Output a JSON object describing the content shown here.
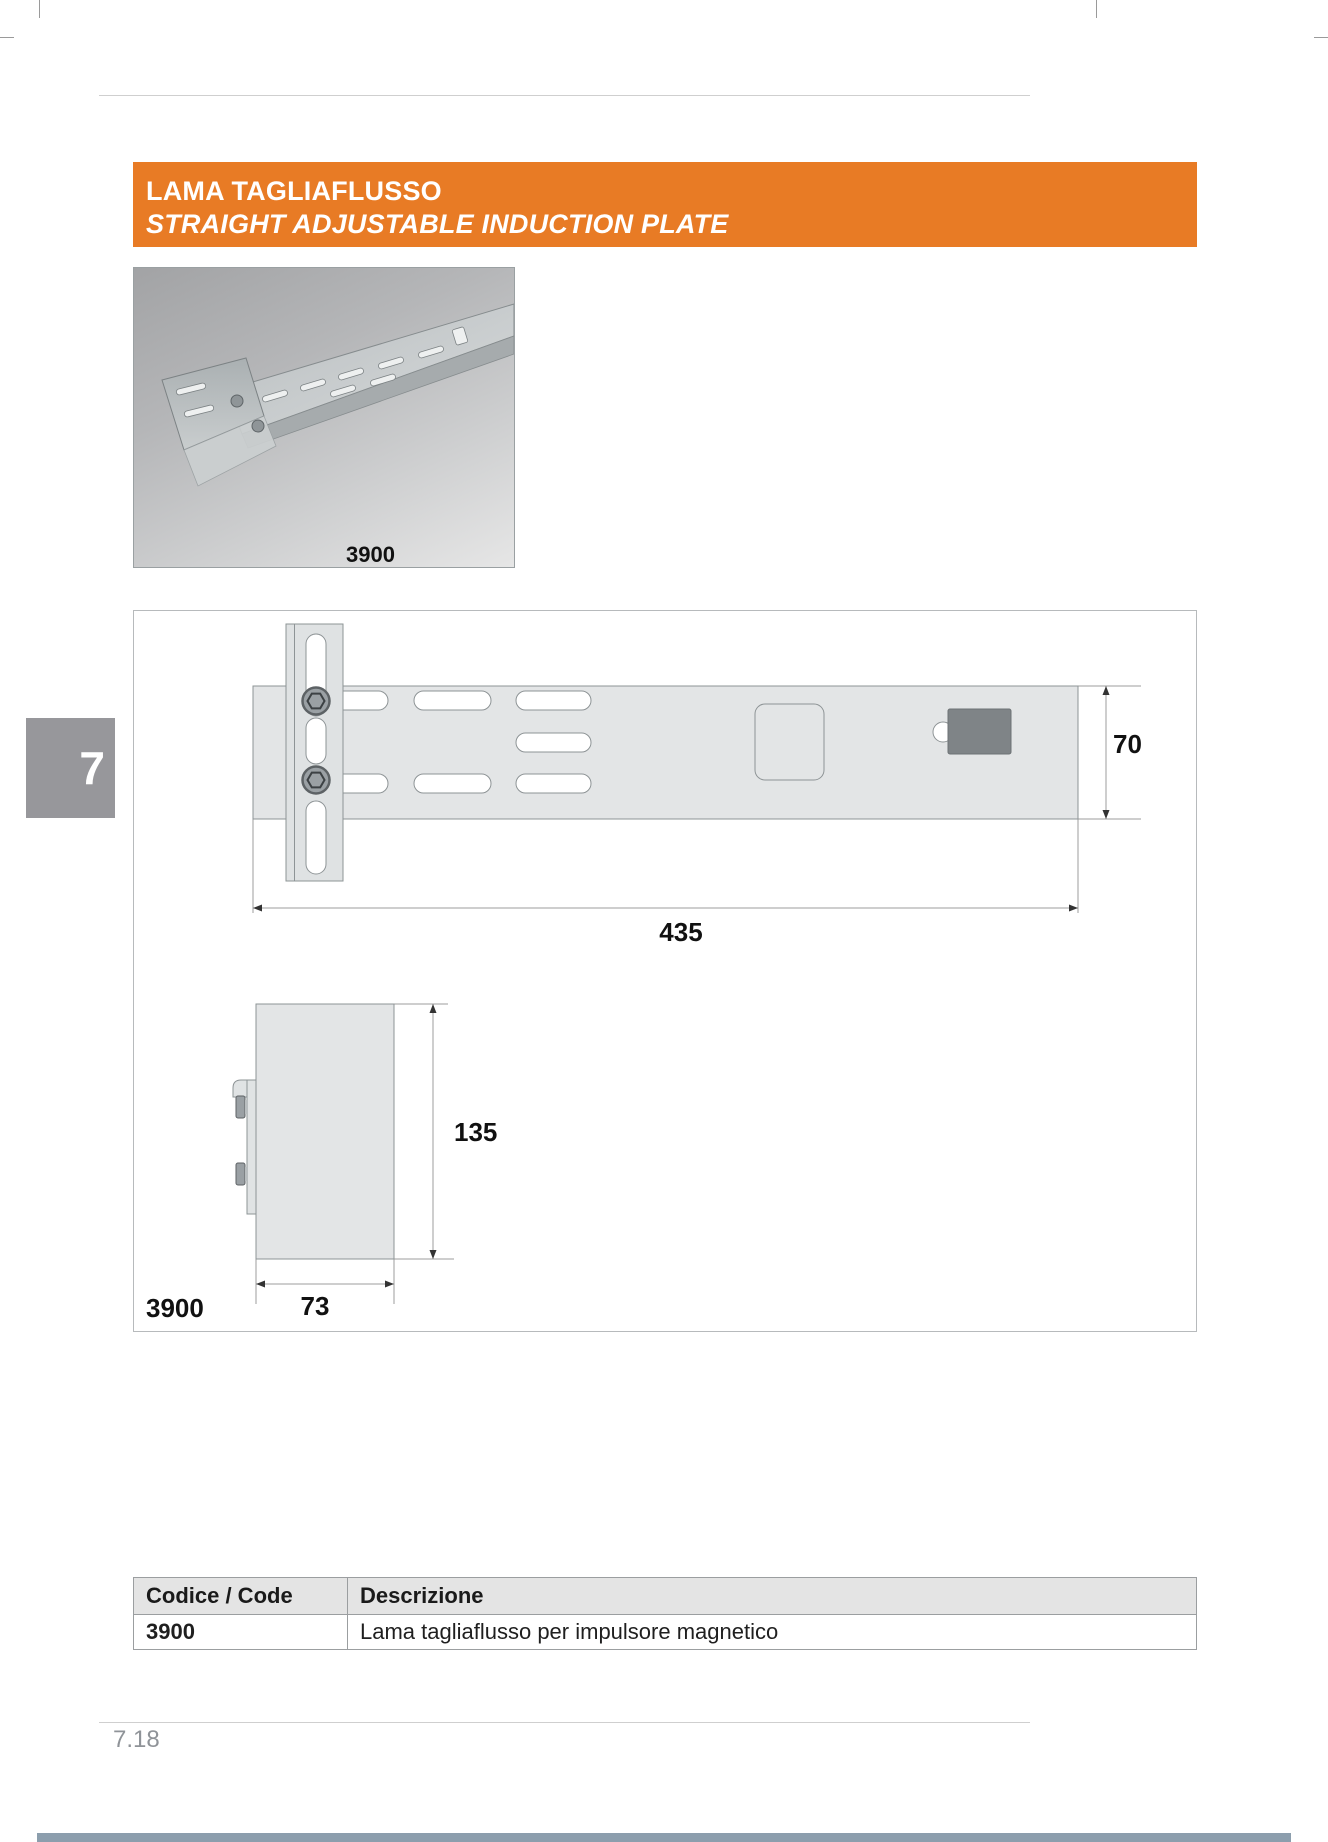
{
  "banner": {
    "line1": "LAMA TAGLIAFLUSSO",
    "line2": "STRAIGHT ADJUSTABLE INDUCTION PLATE"
  },
  "chapter_tab": "7",
  "photo": {
    "caption": "3900"
  },
  "drawing": {
    "code": "3900",
    "dim_length": "435",
    "dim_width": "70",
    "dim_height": "135",
    "dim_depth": "73"
  },
  "table": {
    "col_code": "Codice / Code",
    "col_desc": "Descrizione",
    "rows": [
      {
        "code": "3900",
        "desc": "Lama tagliaflusso per impulsore magnetico"
      }
    ]
  },
  "footer": {
    "page_number": "7.18"
  },
  "colors": {
    "accent_orange": "#E87B25",
    "tab_gray": "#97979B",
    "plate_fill": "#e3e5e6",
    "bottom_bar_blue": "#8C9EAD"
  }
}
